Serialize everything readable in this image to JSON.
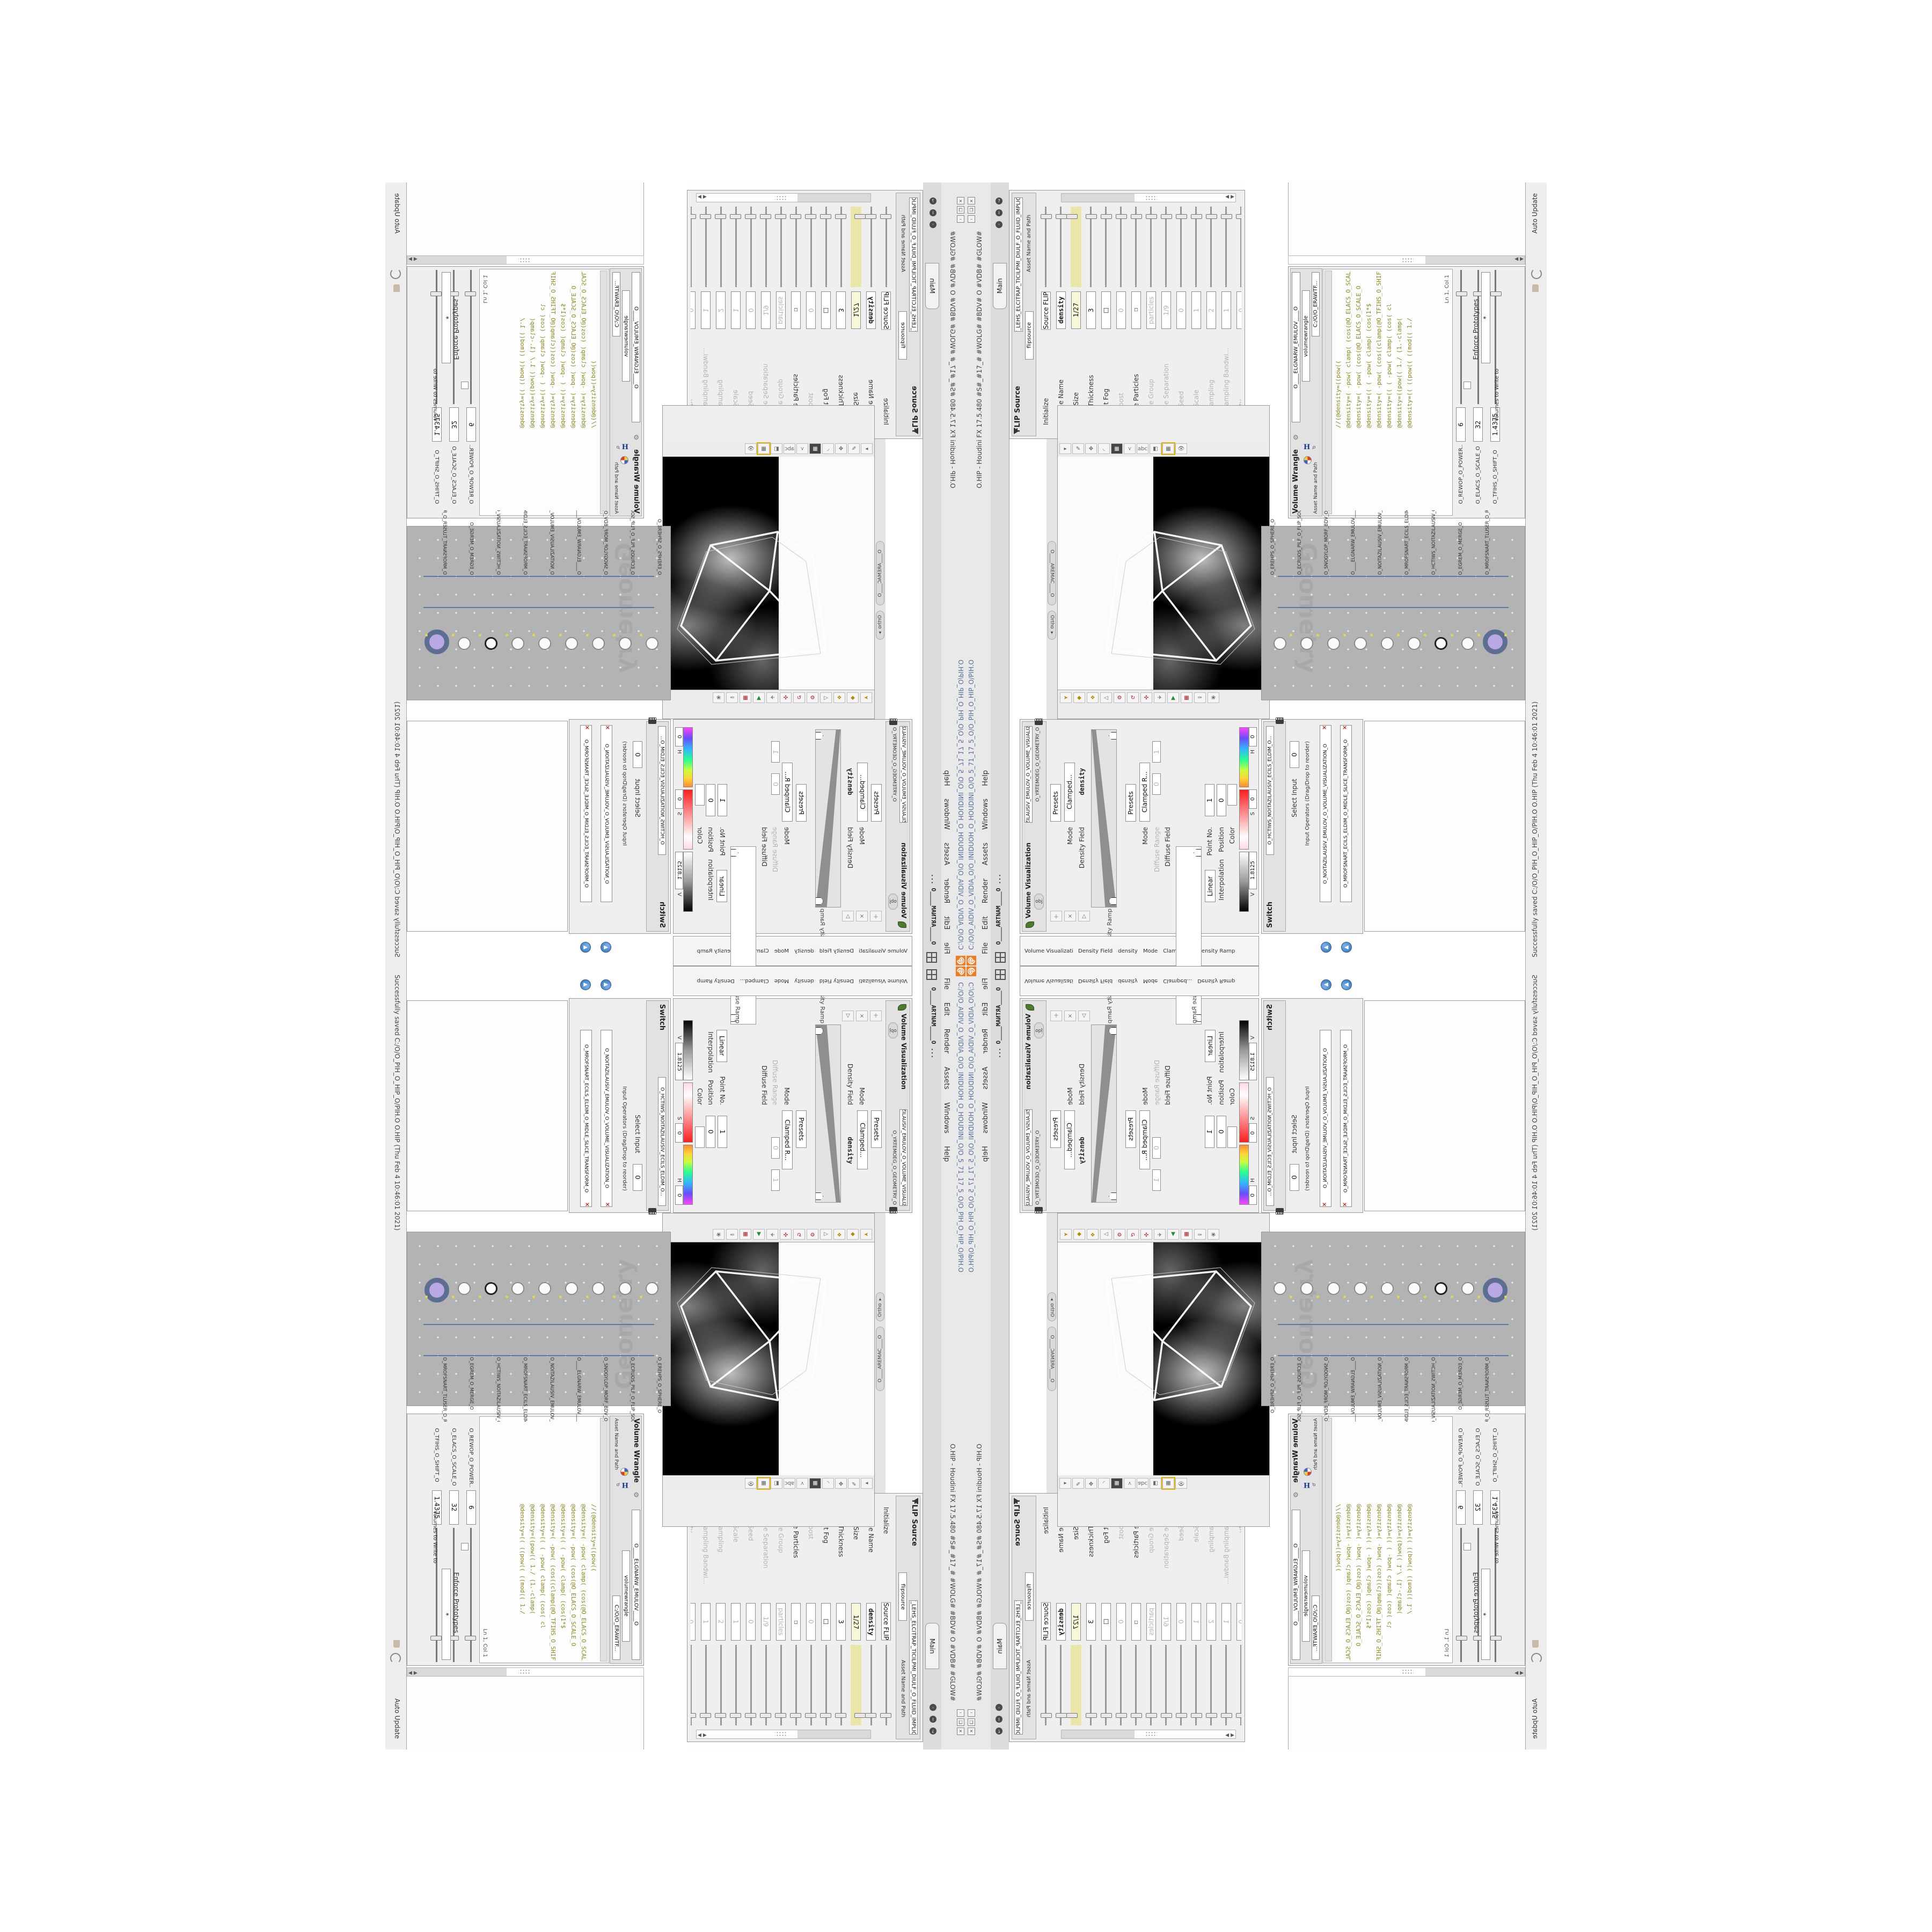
{
  "app": {
    "title_path": "C:/O/O_AIDIV_O_VIDIA_O/O_INIDUOH_O_HOUDINI_O/O_5_71_17_5_O/O_PIH_O_HIP_O/PIH.O",
    "title_app": "O.HIP - Houdini FX 17.5.480   #S#_#17_#  #WOLG#  #BDV#  O  #VDB#  #GLOW#",
    "menu": [
      {
        "label": "File"
      },
      {
        "label": "Edit"
      },
      {
        "label": "Render"
      },
      {
        "label": "Assets"
      },
      {
        "label": "Windows"
      },
      {
        "label": "Help"
      }
    ],
    "main_tab": "Main",
    "status_bar": "Successfully saved C:/O/O_PIH_O_HIP_O/PIH.O      O.HIP (Thu Feb 4 10:46:01 2021)",
    "accent_orange": "#f47b20",
    "window_buttons": [
      "×",
      "❐",
      "–"
    ]
  },
  "tabs": {
    "mantra": "O____ARTNAM____O ...",
    "camera": "O____AREMAC____O",
    "ortho": "Ortho ▾",
    "geometry": "O_YRTEMOEG_O_GEOMETRY_O",
    "obj": "obj"
  },
  "flip": {
    "title": "FLIP Source",
    "node_name": "O_EMULOV_LEHS_ELCITRAP_TICILPMI_DIULF_O_FLUID_IMPLICIT_PARTI...",
    "asset_label": "Asset Name and Path",
    "asset_value": "flipsource",
    "section_particles": "Particles",
    "params": [
      {
        "label": "Initialize",
        "value": "Source FLIP",
        "state": "normal"
      },
      {
        "label": "Volume Name",
        "value": "density",
        "state": "bold"
      },
      {
        "label": "Voxel Size",
        "value": "1/27",
        "state": "hl"
      },
      {
        "label": "Shell Thickness",
        "value": "3",
        "state": "normal"
      },
      {
        "label": "Output Fog",
        "value": "☐",
        "state": "normal"
      },
      {
        "label": "Fog Boost",
        "value": "0",
        "state": "dis"
      },
      {
        "label": "Create Particles",
        "value": "☐",
        "state": "bold"
      },
      {
        "label": "Particle Group",
        "value": "particles",
        "state": "dis"
      },
      {
        "label": "Particle Separation",
        "value": "1/9",
        "state": "dis"
      },
      {
        "label": "Jitter Seed",
        "value": "0",
        "state": "dis"
      },
      {
        "label": "Jitter Scale",
        "value": "1",
        "state": "dis"
      },
      {
        "label": "Oversampling",
        "value": "2",
        "state": "dis"
      },
      {
        "label": "Oversampling Bandwi...",
        "value": "1",
        "state": "dis"
      },
      {
        "label": "Velocity",
        "value": "0",
        "state": "dis"
      },
      {
        "label": "Add Rest Attribute",
        "value": "☐",
        "state": "dis"
      }
    ]
  },
  "wrangle": {
    "title": "Volume Wrangle",
    "node_name": "O____ELGNARW_EMULOV____O",
    "type_name": "volumewrangle",
    "path": "C:/O/O_ERAWTF...",
    "asset_label": "Asset Name and Path",
    "cursor_pos": "Ln 1, Col 1",
    "volumes_label": "Volumes to Write to",
    "volumes_value": "*",
    "enforce": "Enforce Prototypes",
    "auto_update": "Auto Update",
    "code": [
      {
        "line": "//(@density=((pow(("
      },
      {
        "line": "@density=( -pow( clamp( (cos(@O_ELACS_O_SCAL"
      },
      {
        "line": "@density=( -pow(   (cos(@O_ELACS_O_SCALE_O"
      },
      {
        "line": "@density=(( ( -pow( clamp( (cos(1*$"
      },
      {
        "line": "@density=( -pow( (cos((clamp(@O_TFIHS_O_SHIF"
      },
      {
        "line": "@density=(( ( -pow( clamp( (cos( cl"
      },
      {
        "line": "@density=((pow((  1./ (1.-clamp("
      },
      {
        "line": "@density=(( ((pow((  ((mod((  1./"
      }
    ],
    "params": [
      {
        "label": "O_REWOP_O_POWER...",
        "value": "6"
      },
      {
        "label": "O_ELACS_O_SCALE_O",
        "value": "32"
      },
      {
        "label": "O_TFIHS_O_SHIFT_O",
        "value": "1.4375"
      }
    ]
  },
  "viz": {
    "title": "Volume Visualization",
    "node_name": "O_NOITAZILAUSIV_EMULOV_O_VOLUME_VISUALIZATION_O",
    "density_section": "Density Ramp",
    "diffuse_section": "Diffuse Ramp",
    "density_field_label": "Density Field",
    "density_field": "density",
    "mode_label": "Mode",
    "mode_density": "Clamped...",
    "mode_diffuse": "Clamped R...",
    "presets": "Presets",
    "diffuse_field_label": "Diffuse Field",
    "diffuse_range_label": "Diffuse Range",
    "diffuse_min": "0",
    "diffuse_max": "1",
    "point_label": "Point No.",
    "point": "1",
    "position_label": "Position",
    "position": "0",
    "color_label": "Color",
    "interp_label": "Interpolation",
    "interp": "Linear",
    "h_label": "H",
    "h": "0",
    "s_label": "S",
    "s": "0",
    "v_label": "V",
    "v": "1.8125"
  },
  "switch": {
    "title": "Switch",
    "node_name": "O_HCTIWS_NOITAZILAUSIV_ECILS_ELDIM_O...",
    "select_label": "Select Input",
    "select_value": "0",
    "inputs_label": "Input Operators (Drag/Drop to reorder)",
    "items": [
      {
        "name": "O_NOITAZILAUSIV_EMULOV_O_VOLUME_VISUALIZATION_O"
      },
      {
        "name": "O_MROFSNART_ECILS_ELDIM_O_MIDLE_SLICE_TRANSFORM_O"
      }
    ]
  },
  "network": {
    "watermark": "Geometry",
    "nodes": [
      {
        "name": "O_EREHPS_O_SPHERE_O",
        "kind": "plain"
      },
      {
        "name": "O_ECRUOS_PILF_O_FLIP_SOURCE_O",
        "kind": "plain"
      },
      {
        "name": "O_SNOGYLOP_MORF_BDV_O_VDB_FROM_POLYGONS_O",
        "kind": "plain"
      },
      {
        "name": "O____ELGNARW_EMULOV____O",
        "kind": "plain"
      },
      {
        "name": "O_NOITAZILAUSIV_EMULOV_O",
        "kind": "plain"
      },
      {
        "name": "O_MROFSNART_ECILS_ELDIM_O",
        "kind": "plain"
      },
      {
        "name": "O_HCTIWS_NOITAZILAUSIV_O",
        "kind": "ring"
      },
      {
        "name": "O_EGREM_O_MERGE_O",
        "kind": "plain"
      },
      {
        "name": "O_MROFSNART_TLUSER_O_RESULT_TRANSFORM_O",
        "kind": "sel"
      }
    ]
  },
  "seam": {
    "labels": [
      {
        "text": "Volume Visualization"
      },
      {
        "text": "Density Field"
      },
      {
        "text": "density"
      },
      {
        "text": "Mode"
      },
      {
        "text": "Clamped..."
      },
      {
        "text": "Density Ramp"
      }
    ]
  }
}
